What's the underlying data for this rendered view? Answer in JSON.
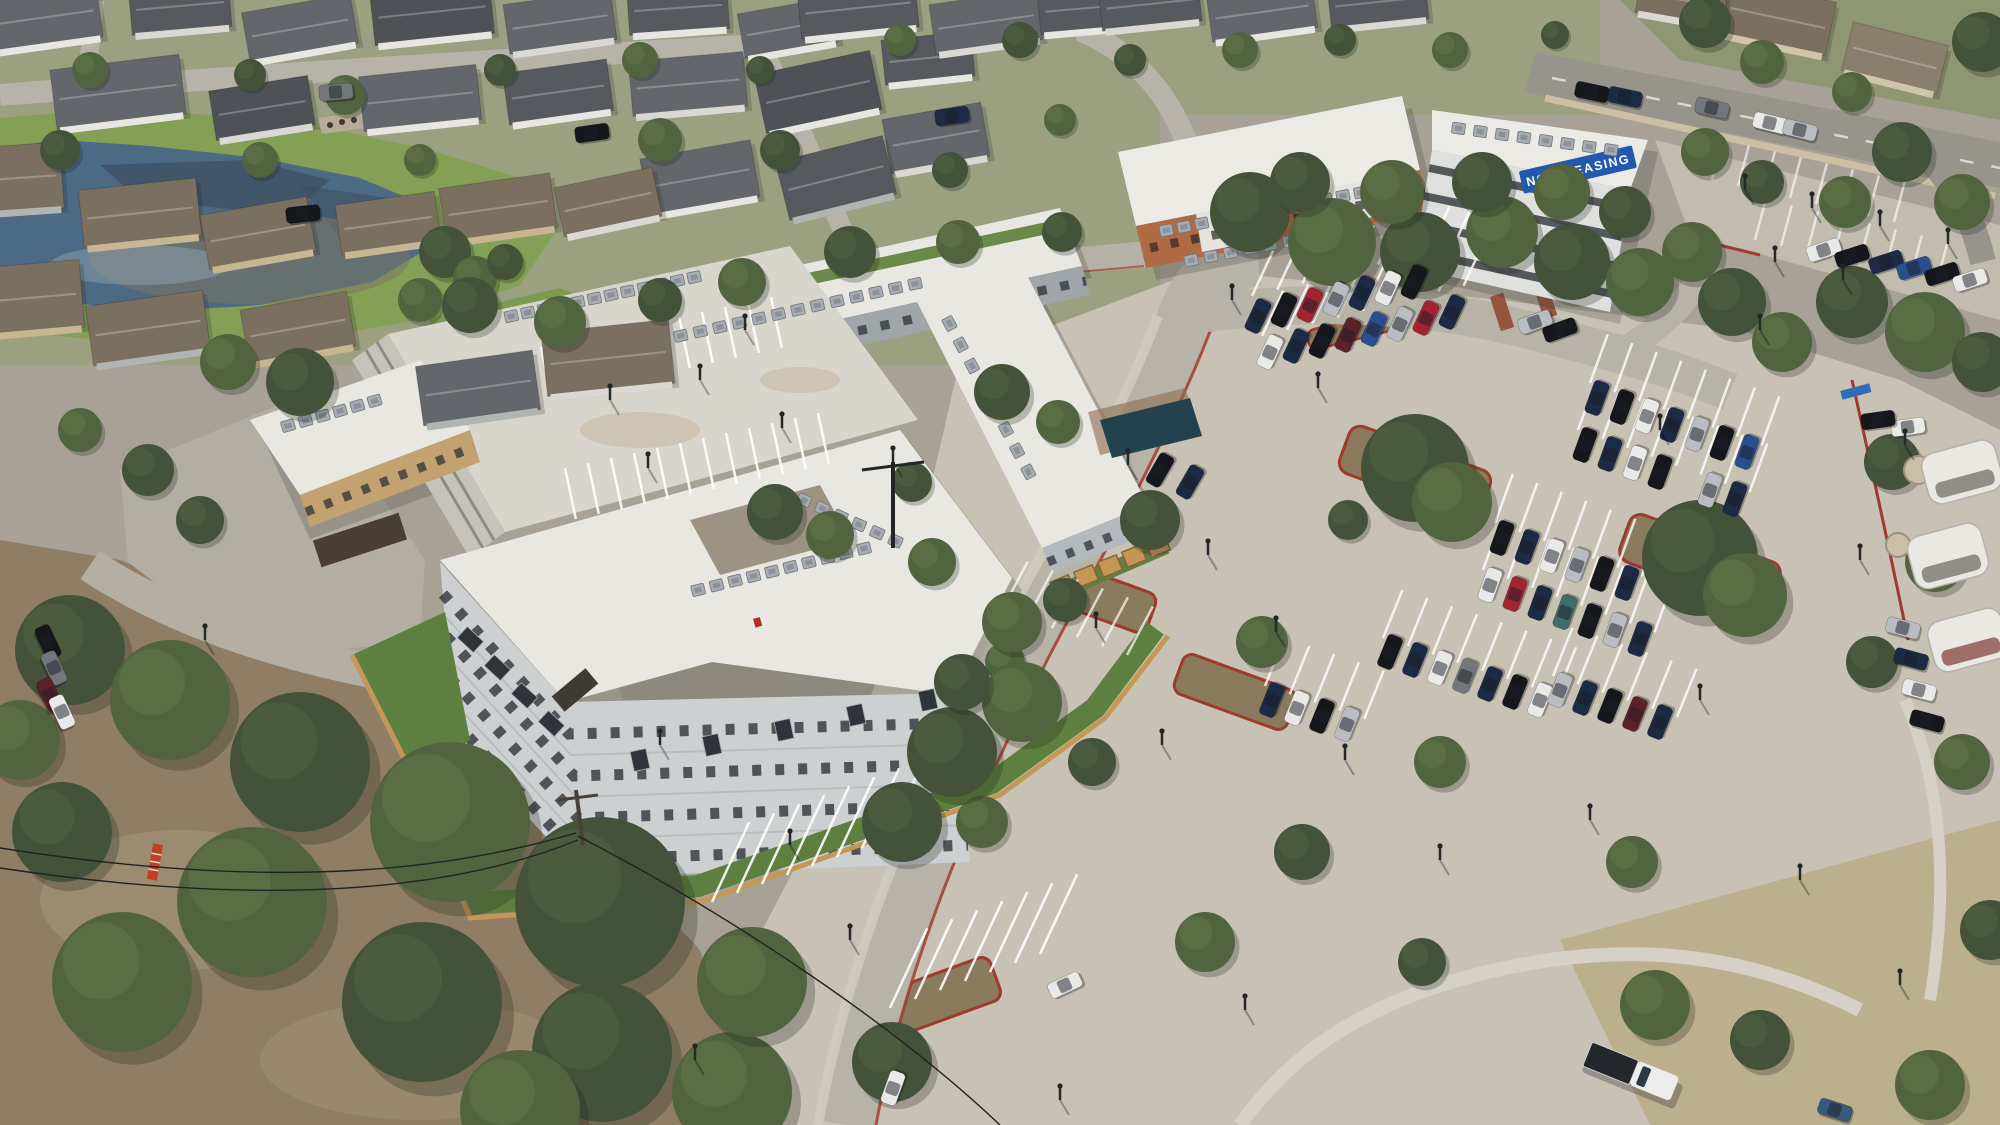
{
  "banner": {
    "text": "NOW LEASING",
    "bg": "#2259ae",
    "fg": "#ffffff"
  },
  "palette": {
    "ground": "#a8a296",
    "neighborhood_ground": "#9ba080",
    "lot_pavement": "#c8c2b5",
    "road": "#b8b3a7",
    "curb_red": "#a13c30",
    "pond_water": "#4d6a84",
    "pond_sediment": "#7d7463",
    "grass": "#83a054",
    "lawn": "#5d8040",
    "dirt": "#8f7e65",
    "roof_white": "#e9e7e1",
    "wall_light": "#ccd0d1",
    "wall_gray": "#9fa5a8",
    "brick": "#b06a44",
    "blonde_brick": "#c2a270",
    "wood_fence": "#c49757",
    "mulch": "#8a7a5e",
    "cars": [
      "#1d2a45",
      "#15171b",
      "#e9e9e7",
      "#b9bcc0",
      "#a32430",
      "#5e2029",
      "#2a4f8f",
      "#73777c",
      "#3e6e68",
      "#3a5a7a"
    ],
    "houseBody": [
      "#e7e6e0",
      "#d9d8d2",
      "#c8b692",
      "#b0b5b1",
      "#cfc5ab"
    ],
    "houseRoof": [
      "#63676c",
      "#565a5f",
      "#8a7f6c",
      "#6f7376",
      "#7b6f60",
      "#4e5257"
    ],
    "treeShades": [
      "#44523a",
      "#52633f",
      "#637547",
      "#78895a"
    ]
  },
  "houses": [
    [
      40,
      18,
      -8,
      120,
      55,
      0,
      0
    ],
    [
      180,
      6,
      -5,
      100,
      50,
      1,
      1
    ],
    [
      300,
      28,
      -10,
      110,
      50,
      0,
      0
    ],
    [
      432,
      12,
      -6,
      120,
      55,
      0,
      5
    ],
    [
      560,
      22,
      -8,
      108,
      50,
      1,
      0
    ],
    [
      678,
      8,
      -4,
      100,
      48,
      0,
      1
    ],
    [
      788,
      28,
      -10,
      95,
      45,
      0,
      0
    ],
    [
      118,
      92,
      -7,
      130,
      60,
      0,
      0
    ],
    [
      262,
      108,
      -9,
      100,
      50,
      1,
      5
    ],
    [
      420,
      98,
      -6,
      118,
      55,
      0,
      0
    ],
    [
      558,
      92,
      -8,
      105,
      52,
      0,
      1
    ],
    [
      688,
      84,
      -5,
      115,
      55,
      1,
      0
    ],
    [
      818,
      92,
      -12,
      118,
      60,
      0,
      5
    ],
    [
      928,
      58,
      -6,
      90,
      45,
      0,
      1
    ],
    [
      936,
      138,
      -10,
      100,
      55,
      1,
      0
    ],
    [
      836,
      178,
      -14,
      110,
      60,
      3,
      1
    ],
    [
      700,
      178,
      -10,
      112,
      58,
      0,
      0
    ],
    [
      18,
      178,
      -4,
      88,
      66,
      3,
      4
    ],
    [
      140,
      213,
      -6,
      118,
      58,
      2,
      4
    ],
    [
      258,
      233,
      -10,
      108,
      55,
      2,
      4
    ],
    [
      388,
      223,
      -8,
      100,
      50,
      2,
      4
    ],
    [
      498,
      208,
      -8,
      112,
      55,
      2,
      4
    ],
    [
      608,
      202,
      -12,
      100,
      50,
      1,
      4
    ],
    [
      28,
      298,
      -5,
      108,
      68,
      2,
      4
    ],
    [
      148,
      328,
      -8,
      118,
      60,
      3,
      4
    ],
    [
      298,
      328,
      -10,
      108,
      55,
      2,
      4
    ],
    [
      478,
      388,
      -8,
      118,
      60,
      3,
      0
    ],
    [
      608,
      358,
      -6,
      128,
      64,
      1,
      4
    ],
    [
      1778,
      18,
      12,
      108,
      55,
      4,
      4
    ],
    [
      1895,
      58,
      14,
      98,
      50,
      4,
      2
    ],
    [
      1682,
      0,
      10,
      88,
      40,
      1,
      4
    ],
    [
      858,
      8,
      -6,
      118,
      50,
      0,
      1
    ],
    [
      986,
      22,
      -8,
      108,
      50,
      1,
      0
    ],
    [
      1088,
      8,
      -5,
      98,
      45,
      0,
      1
    ],
    [
      1150,
      4,
      -6,
      100,
      44,
      1,
      1
    ],
    [
      1262,
      12,
      -8,
      106,
      46,
      0,
      0
    ],
    [
      1378,
      2,
      -6,
      98,
      44,
      1,
      1
    ]
  ],
  "trees": [
    [
      90,
      70,
      18,
      1
    ],
    [
      250,
      75,
      16,
      0
    ],
    [
      345,
      95,
      20,
      1
    ],
    [
      500,
      70,
      16,
      0
    ],
    [
      640,
      60,
      18,
      1
    ],
    [
      760,
      70,
      14,
      0
    ],
    [
      900,
      40,
      16,
      1
    ],
    [
      1020,
      40,
      18,
      0
    ],
    [
      660,
      140,
      22,
      1
    ],
    [
      780,
      150,
      20,
      0
    ],
    [
      260,
      160,
      18,
      1
    ],
    [
      60,
      150,
      20,
      0
    ],
    [
      420,
      160,
      16,
      1
    ],
    [
      950,
      170,
      18,
      0
    ],
    [
      1060,
      120,
      16,
      1
    ],
    [
      1130,
      60,
      16,
      0
    ],
    [
      1240,
      50,
      18,
      1
    ],
    [
      1340,
      40,
      16,
      0
    ],
    [
      1450,
      50,
      18,
      1
    ],
    [
      1555,
      35,
      14,
      0
    ],
    [
      445,
      252,
      26,
      0
    ],
    [
      475,
      278,
      22,
      1
    ],
    [
      505,
      262,
      18,
      0
    ],
    [
      420,
      300,
      22,
      1
    ],
    [
      470,
      305,
      28,
      0
    ],
    [
      560,
      322,
      26,
      1
    ],
    [
      300,
      382,
      34,
      0
    ],
    [
      228,
      362,
      28,
      1
    ],
    [
      660,
      300,
      22,
      0
    ],
    [
      742,
      282,
      24,
      1
    ],
    [
      850,
      252,
      26,
      0
    ],
    [
      958,
      242,
      22,
      1
    ],
    [
      1062,
      232,
      20,
      0
    ],
    [
      148,
      470,
      26,
      0
    ],
    [
      80,
      430,
      22,
      1
    ],
    [
      200,
      520,
      24,
      0
    ],
    [
      1250,
      212,
      40,
      0
    ],
    [
      1332,
      242,
      44,
      1
    ],
    [
      1420,
      252,
      40,
      0
    ],
    [
      1502,
      232,
      36,
      1
    ],
    [
      1572,
      262,
      38,
      0
    ],
    [
      1640,
      282,
      34,
      1
    ],
    [
      1300,
      182,
      30,
      0
    ],
    [
      1392,
      192,
      32,
      1
    ],
    [
      1482,
      182,
      30,
      0
    ],
    [
      1562,
      192,
      28,
      1
    ],
    [
      1625,
      212,
      26,
      0
    ],
    [
      1692,
      252,
      30,
      1
    ],
    [
      1732,
      302,
      34,
      0
    ],
    [
      1782,
      342,
      30,
      1
    ],
    [
      1852,
      302,
      36,
      0
    ],
    [
      1925,
      332,
      40,
      1
    ],
    [
      1982,
      362,
      30,
      0
    ],
    [
      1705,
      152,
      24,
      1
    ],
    [
      1762,
      182,
      22,
      0
    ],
    [
      1845,
      202,
      26,
      1
    ],
    [
      1902,
      152,
      30,
      0
    ],
    [
      1962,
      202,
      28,
      1
    ],
    [
      1705,
      22,
      26,
      0
    ],
    [
      1762,
      62,
      22,
      1
    ],
    [
      1982,
      42,
      30,
      0
    ],
    [
      1852,
      92,
      20,
      1
    ],
    [
      1415,
      468,
      54,
      0
    ],
    [
      1452,
      502,
      40,
      1
    ],
    [
      1700,
      558,
      58,
      0
    ],
    [
      1745,
      595,
      42,
      1
    ],
    [
      1150,
      520,
      30,
      0
    ],
    [
      1262,
      642,
      26,
      1
    ],
    [
      1065,
      600,
      22,
      0
    ],
    [
      1005,
      662,
      20,
      1
    ],
    [
      1348,
      520,
      20,
      0
    ],
    [
      1440,
      762,
      26,
      1
    ],
    [
      1302,
      852,
      28,
      0
    ],
    [
      1205,
      942,
      30,
      1
    ],
    [
      1422,
      962,
      24,
      0
    ],
    [
      1632,
      862,
      26,
      1
    ],
    [
      1892,
      462,
      28,
      0
    ],
    [
      1935,
      562,
      30,
      1
    ],
    [
      1872,
      662,
      26,
      0
    ],
    [
      1962,
      762,
      28,
      1
    ],
    [
      1092,
      762,
      24,
      0
    ],
    [
      982,
      822,
      26,
      1
    ],
    [
      70,
      650,
      55,
      0
    ],
    [
      170,
      700,
      60,
      1
    ],
    [
      300,
      762,
      70,
      0
    ],
    [
      450,
      822,
      80,
      1
    ],
    [
      600,
      902,
      85,
      0
    ],
    [
      252,
      902,
      75,
      1
    ],
    [
      422,
      1002,
      80,
      0
    ],
    [
      122,
      982,
      70,
      1
    ],
    [
      602,
      1052,
      70,
      0
    ],
    [
      732,
      1092,
      60,
      1
    ],
    [
      62,
      832,
      50,
      0
    ],
    [
      752,
      982,
      55,
      1
    ],
    [
      892,
      1062,
      40,
      0
    ],
    [
      520,
      1110,
      60,
      1
    ],
    [
      20,
      740,
      40,
      1
    ],
    [
      952,
      752,
      45,
      0
    ],
    [
      1022,
      702,
      40,
      1
    ],
    [
      902,
      822,
      40,
      0
    ],
    [
      1655,
      1005,
      35,
      1
    ],
    [
      1760,
      1040,
      30,
      0
    ],
    [
      1930,
      1085,
      35,
      1
    ],
    [
      1990,
      930,
      30,
      0
    ],
    [
      775,
      512,
      28,
      0
    ],
    [
      830,
      535,
      24,
      1
    ],
    [
      1002,
      392,
      28,
      0
    ],
    [
      1058,
      422,
      22,
      1
    ],
    [
      912,
      482,
      20,
      0
    ],
    [
      1012,
      622,
      30,
      1
    ],
    [
      962,
      682,
      28,
      0
    ],
    [
      932,
      562,
      24,
      1
    ]
  ],
  "cars": [
    [
      1258,
      316,
      -65,
      0
    ],
    [
      1284,
      310,
      -65,
      1
    ],
    [
      1310,
      305,
      -65,
      4
    ],
    [
      1336,
      299,
      -65,
      3
    ],
    [
      1362,
      293,
      -65,
      0
    ],
    [
      1388,
      288,
      -65,
      2
    ],
    [
      1414,
      282,
      -65,
      1
    ],
    [
      1270,
      352,
      -65,
      2
    ],
    [
      1296,
      346,
      -65,
      0
    ],
    [
      1322,
      341,
      -65,
      1
    ],
    [
      1348,
      335,
      -65,
      5
    ],
    [
      1374,
      329,
      -65,
      6
    ],
    [
      1400,
      324,
      -65,
      3
    ],
    [
      1426,
      318,
      -65,
      4
    ],
    [
      1452,
      312,
      -65,
      0
    ],
    [
      1824,
      250,
      -18,
      2
    ],
    [
      1852,
      256,
      -18,
      1
    ],
    [
      1886,
      262,
      -18,
      0
    ],
    [
      1914,
      268,
      -18,
      6
    ],
    [
      1942,
      274,
      -18,
      1
    ],
    [
      1970,
      280,
      -18,
      2
    ],
    [
      1597,
      398,
      -70,
      0
    ],
    [
      1622,
      407,
      -70,
      1
    ],
    [
      1647,
      416,
      -70,
      2
    ],
    [
      1672,
      425,
      -70,
      0
    ],
    [
      1697,
      434,
      -70,
      3
    ],
    [
      1722,
      443,
      -70,
      1
    ],
    [
      1747,
      452,
      -70,
      6
    ],
    [
      1585,
      445,
      -70,
      1
    ],
    [
      1610,
      454,
      -70,
      0
    ],
    [
      1635,
      463,
      -70,
      2
    ],
    [
      1660,
      472,
      -70,
      1
    ],
    [
      1710,
      490,
      -70,
      3
    ],
    [
      1735,
      499,
      -70,
      0
    ],
    [
      1502,
      538,
      -70,
      1
    ],
    [
      1527,
      547,
      -70,
      0
    ],
    [
      1552,
      556,
      -70,
      2
    ],
    [
      1577,
      565,
      -70,
      3
    ],
    [
      1602,
      574,
      -70,
      1
    ],
    [
      1627,
      583,
      -70,
      0
    ],
    [
      1490,
      585,
      -70,
      2
    ],
    [
      1515,
      594,
      -70,
      4
    ],
    [
      1540,
      603,
      -70,
      0
    ],
    [
      1565,
      612,
      -70,
      8
    ],
    [
      1590,
      621,
      -70,
      1
    ],
    [
      1615,
      630,
      -70,
      3
    ],
    [
      1640,
      639,
      -70,
      0
    ],
    [
      1390,
      652,
      -68,
      1
    ],
    [
      1415,
      660,
      -68,
      0
    ],
    [
      1440,
      668,
      -68,
      2
    ],
    [
      1465,
      676,
      -68,
      7
    ],
    [
      1490,
      684,
      -68,
      0
    ],
    [
      1515,
      692,
      -68,
      1
    ],
    [
      1540,
      700,
      -68,
      2
    ],
    [
      1560,
      690,
      -68,
      3
    ],
    [
      1585,
      698,
      -68,
      0
    ],
    [
      1610,
      706,
      -68,
      1
    ],
    [
      1635,
      714,
      -68,
      5
    ],
    [
      1660,
      722,
      -68,
      0
    ],
    [
      1272,
      700,
      -68,
      0
    ],
    [
      1297,
      708,
      -68,
      2
    ],
    [
      1322,
      716,
      -68,
      1
    ],
    [
      1347,
      724,
      -68,
      3
    ],
    [
      1903,
      628,
      15,
      3
    ],
    [
      1911,
      659,
      15,
      0
    ],
    [
      1919,
      690,
      15,
      2
    ],
    [
      1927,
      721,
      15,
      1
    ],
    [
      1160,
      470,
      -60,
      1
    ],
    [
      1190,
      482,
      -60,
      0
    ],
    [
      1065,
      985,
      -25,
      2
    ],
    [
      893,
      1088,
      -70,
      2
    ],
    [
      1592,
      92,
      12,
      1
    ],
    [
      1625,
      97,
      12,
      0
    ],
    [
      1770,
      123,
      14,
      2
    ],
    [
      1800,
      130,
      14,
      3
    ],
    [
      1712,
      108,
      13,
      7
    ],
    [
      592,
      133,
      -8,
      1
    ],
    [
      336,
      92,
      -5,
      7
    ],
    [
      952,
      116,
      -8,
      0
    ],
    [
      303,
      214,
      -6,
      1
    ],
    [
      48,
      642,
      65,
      1
    ],
    [
      54,
      668,
      65,
      7
    ],
    [
      50,
      695,
      65,
      5
    ],
    [
      62,
      712,
      65,
      2
    ],
    [
      1835,
      1110,
      18,
      9
    ],
    [
      1908,
      427,
      -8,
      2
    ],
    [
      1878,
      420,
      -8,
      1
    ],
    [
      1560,
      330,
      -20,
      1
    ],
    [
      1535,
      322,
      -20,
      3
    ]
  ],
  "stripes": [
    {
      "x": 1252,
      "y": 296,
      "a": -65,
      "n": 9,
      "dx": 25.2,
      "dy": -6.3,
      "l": 50,
      "o": 0.8
    },
    {
      "x": 1262,
      "y": 336,
      "a": -65,
      "n": 9,
      "dx": 25.2,
      "dy": -6.3,
      "l": 50,
      "o": 0.8
    },
    {
      "x": 1590,
      "y": 383,
      "a": -70,
      "n": 8,
      "dx": 24.5,
      "dy": 8.9,
      "l": 52,
      "o": 0.8
    },
    {
      "x": 1578,
      "y": 430,
      "a": -70,
      "n": 8,
      "dx": 24.5,
      "dy": 8.9,
      "l": 52,
      "o": 0.8
    },
    {
      "x": 1495,
      "y": 523,
      "a": -70,
      "n": 7,
      "dx": 24.5,
      "dy": 8.9,
      "l": 52,
      "o": 0.8
    },
    {
      "x": 1483,
      "y": 570,
      "a": -70,
      "n": 8,
      "dx": 24.5,
      "dy": 8.9,
      "l": 52,
      "o": 0.8
    },
    {
      "x": 1383,
      "y": 638,
      "a": -68,
      "n": 8,
      "dx": 24.8,
      "dy": 8.2,
      "l": 52,
      "o": 0.8
    },
    {
      "x": 1553,
      "y": 676,
      "a": -68,
      "n": 6,
      "dx": 24.8,
      "dy": 8.2,
      "l": 52,
      "o": 0.8
    },
    {
      "x": 1265,
      "y": 686,
      "a": -68,
      "n": 5,
      "dx": 24.8,
      "dy": 8.2,
      "l": 52,
      "o": 0.8
    },
    {
      "x": 712,
      "y": 902,
      "a": -65,
      "n": 8,
      "dx": 25,
      "dy": -9,
      "l": 88,
      "o": 0.9
    },
    {
      "x": 890,
      "y": 1008,
      "a": -65,
      "n": 7,
      "dx": 25,
      "dy": -9,
      "l": 88,
      "o": 0.9
    },
    {
      "x": 1002,
      "y": 610,
      "a": -62,
      "n": 6,
      "dx": 25,
      "dy": 9,
      "l": 55,
      "o": 0.7
    },
    {
      "x": 518,
      "y": 352,
      "a": 78,
      "n": 12,
      "dx": 23,
      "dy": -5,
      "l": 52,
      "o": 0.9
    },
    {
      "x": 565,
      "y": 468,
      "a": 78,
      "n": 12,
      "dx": 23,
      "dy": -5,
      "l": 52,
      "o": 0.9
    },
    {
      "x": 1712,
      "y": 180,
      "a": -75,
      "n": 8,
      "dx": 26,
      "dy": 6,
      "l": 42,
      "o": 0.6
    },
    {
      "x": 1755,
      "y": 240,
      "a": -75,
      "n": 8,
      "dx": 26,
      "dy": 6,
      "l": 42,
      "o": 0.6
    },
    {
      "x": 58,
      "y": 612,
      "a": 60,
      "n": 5,
      "dx": 16,
      "dy": 19,
      "l": 38,
      "o": 0.85
    }
  ],
  "hvac": [
    {
      "x": 505,
      "y": 318,
      "a": -12,
      "n": 12,
      "s": 17
    },
    {
      "x": 655,
      "y": 342,
      "a": -12.5,
      "n": 14,
      "s": 20
    },
    {
      "x": 1160,
      "y": 232,
      "a": -11,
      "n": 13,
      "s": 18
    },
    {
      "x": 1185,
      "y": 262,
      "a": -11,
      "n": 8,
      "s": 20
    },
    {
      "x": 1452,
      "y": 128,
      "a": 8,
      "n": 8,
      "s": 22
    },
    {
      "x": 946,
      "y": 318,
      "a": 62,
      "n": 8,
      "s": 24
    },
    {
      "x": 692,
      "y": 592,
      "a": -14,
      "n": 10,
      "s": 19
    },
    {
      "x": 798,
      "y": 498,
      "a": 24,
      "n": 6,
      "s": 20
    },
    {
      "x": 282,
      "y": 428,
      "a": -16,
      "n": 6,
      "s": 18
    }
  ],
  "poles": [
    [
      1232,
      300
    ],
    [
      1318,
      388
    ],
    [
      1128,
      465
    ],
    [
      1208,
      555
    ],
    [
      1096,
      628
    ],
    [
      1276,
      632
    ],
    [
      1162,
      745
    ],
    [
      1345,
      760
    ],
    [
      1440,
      860
    ],
    [
      1245,
      1010
    ],
    [
      1660,
      430
    ],
    [
      1760,
      330
    ],
    [
      1860,
      560
    ],
    [
      1905,
      445
    ],
    [
      1700,
      700
    ],
    [
      1590,
      820
    ],
    [
      1800,
      880
    ],
    [
      850,
      940
    ],
    [
      790,
      845
    ],
    [
      695,
      1060
    ],
    [
      1060,
      1100
    ],
    [
      1900,
      985
    ],
    [
      205,
      640
    ],
    [
      660,
      745
    ],
    [
      1745,
      190
    ],
    [
      1812,
      208
    ],
    [
      1880,
      226
    ],
    [
      1948,
      244
    ],
    [
      1775,
      262
    ],
    [
      1843,
      280
    ],
    [
      893,
      462
    ],
    [
      610,
      400
    ],
    [
      700,
      380
    ],
    [
      782,
      428
    ],
    [
      648,
      468
    ],
    [
      745,
      330
    ]
  ]
}
